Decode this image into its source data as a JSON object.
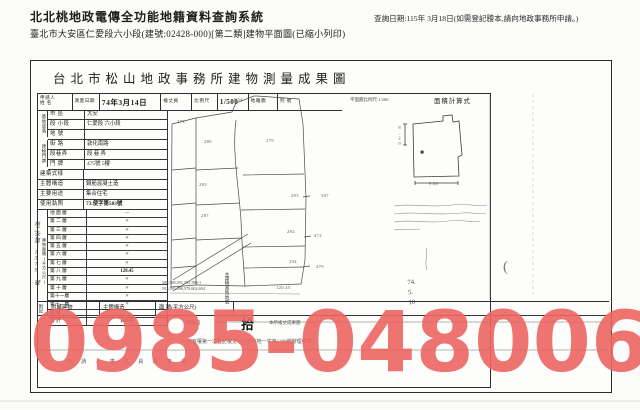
{
  "header": {
    "system_title": "北北桃地政電傳全功能地籍資料查詢系統",
    "query_date": "查詢日期:115年 3月18日(如需登記謄本,請向地政事務所申請。)",
    "subtitle": "臺北市大安區仁愛段六小段(建號:02428-000)[第二類]建物平面圖(已縮小列印)"
  },
  "doc": {
    "title": "台北市松山地政事務所建物測量成果圖",
    "form_header": {
      "applicant": "申請人",
      "applicant2": "姓 名",
      "survey_date_label": "測量日期",
      "survey_date": "74年3月14日",
      "surveyor": "複丈員",
      "scale_label": "比例尺",
      "scale": "1/500",
      "map": "地籍圖",
      "sheet": "列   號",
      "plan_scale": "平面圖比例尺:1/200",
      "area_calc": "面積計算式"
    },
    "site": {
      "group": "基地坐落",
      "rows": [
        {
          "label": "市  區",
          "value": "大安"
        },
        {
          "label": "段 小段",
          "value": "仁愛段 六小段"
        },
        {
          "label": "地  號",
          "value": ""
        }
      ]
    },
    "addr": {
      "group": "建物門牌",
      "rows": [
        {
          "label": "街  路",
          "value": "敦化南路"
        },
        {
          "label": "段巷弄",
          "value": "段  巷  弄"
        },
        {
          "label": "門  牌",
          "value": "475號 5樓"
        }
      ]
    },
    "attrs": [
      {
        "label": "建築式樣",
        "value": ""
      },
      {
        "label": "主體構造",
        "value": "鋼筋混凝土造"
      },
      {
        "label": "主要用途",
        "value": "集合住宅"
      },
      {
        "label": "使用執照",
        "value": "73.使字第503號"
      }
    ],
    "floors_label": "建物面積(平方公尺)",
    "floors": [
      {
        "label": "地 面 層",
        "value": "—"
      },
      {
        "label": "第 二 層",
        "value": "〃"
      },
      {
        "label": "第 三 層",
        "value": "〃"
      },
      {
        "label": "第 四 層",
        "value": "〃"
      },
      {
        "label": "第 五 層",
        "value": "〃"
      },
      {
        "label": "第 六 層",
        "value": "〃"
      },
      {
        "label": "第 七 層",
        "value": "〃"
      },
      {
        "label": "第 八 層",
        "value": "128.45"
      },
      {
        "label": "第 九 層",
        "value": "〃"
      },
      {
        "label": "第 十 層",
        "value": "〃"
      },
      {
        "label": "第十一層",
        "value": "〃"
      },
      {
        "label": "第十二層",
        "value": "〃"
      },
      {
        "label": "騎  樓",
        "value": ""
      },
      {
        "label": "合  計",
        "value": "128.45"
      }
    ],
    "bottom": {
      "attach": "附記",
      "appendage": "附屬建物",
      "structure": "主體構造",
      "area": "面 積(平方公尺)",
      "lot_label": "主建物基地地號",
      "lots1": "586,588,591,592,594-1",
      "lots2": "593,595,596,579,602,604",
      "stamp": "拾",
      "note1_left": "轉繪自",
      "note1_right": "本所複丈成果圖",
      "note2": "所有權第一次登記複丈 (73)北市地一字第1209號辦理移算",
      "signatures": "申 請 人        複 丈 員        檢 查 員",
      "margin_note": "地二字第 1379 號",
      "paren": "(",
      "date_stamp1": "74.",
      "date_stamp2": "5.",
      "date_stamp3": "10"
    },
    "sketch": {
      "parcels": [
        "C34",
        "279",
        "280",
        "283",
        "287",
        "293",
        "292",
        "294",
        "507",
        "472",
        "470",
        "273",
        "120.45"
      ],
      "dims": [
        "8.29",
        "9.60"
      ]
    }
  },
  "watermark": {
    "text": "0985-048006",
    "color": "#ec6661"
  }
}
